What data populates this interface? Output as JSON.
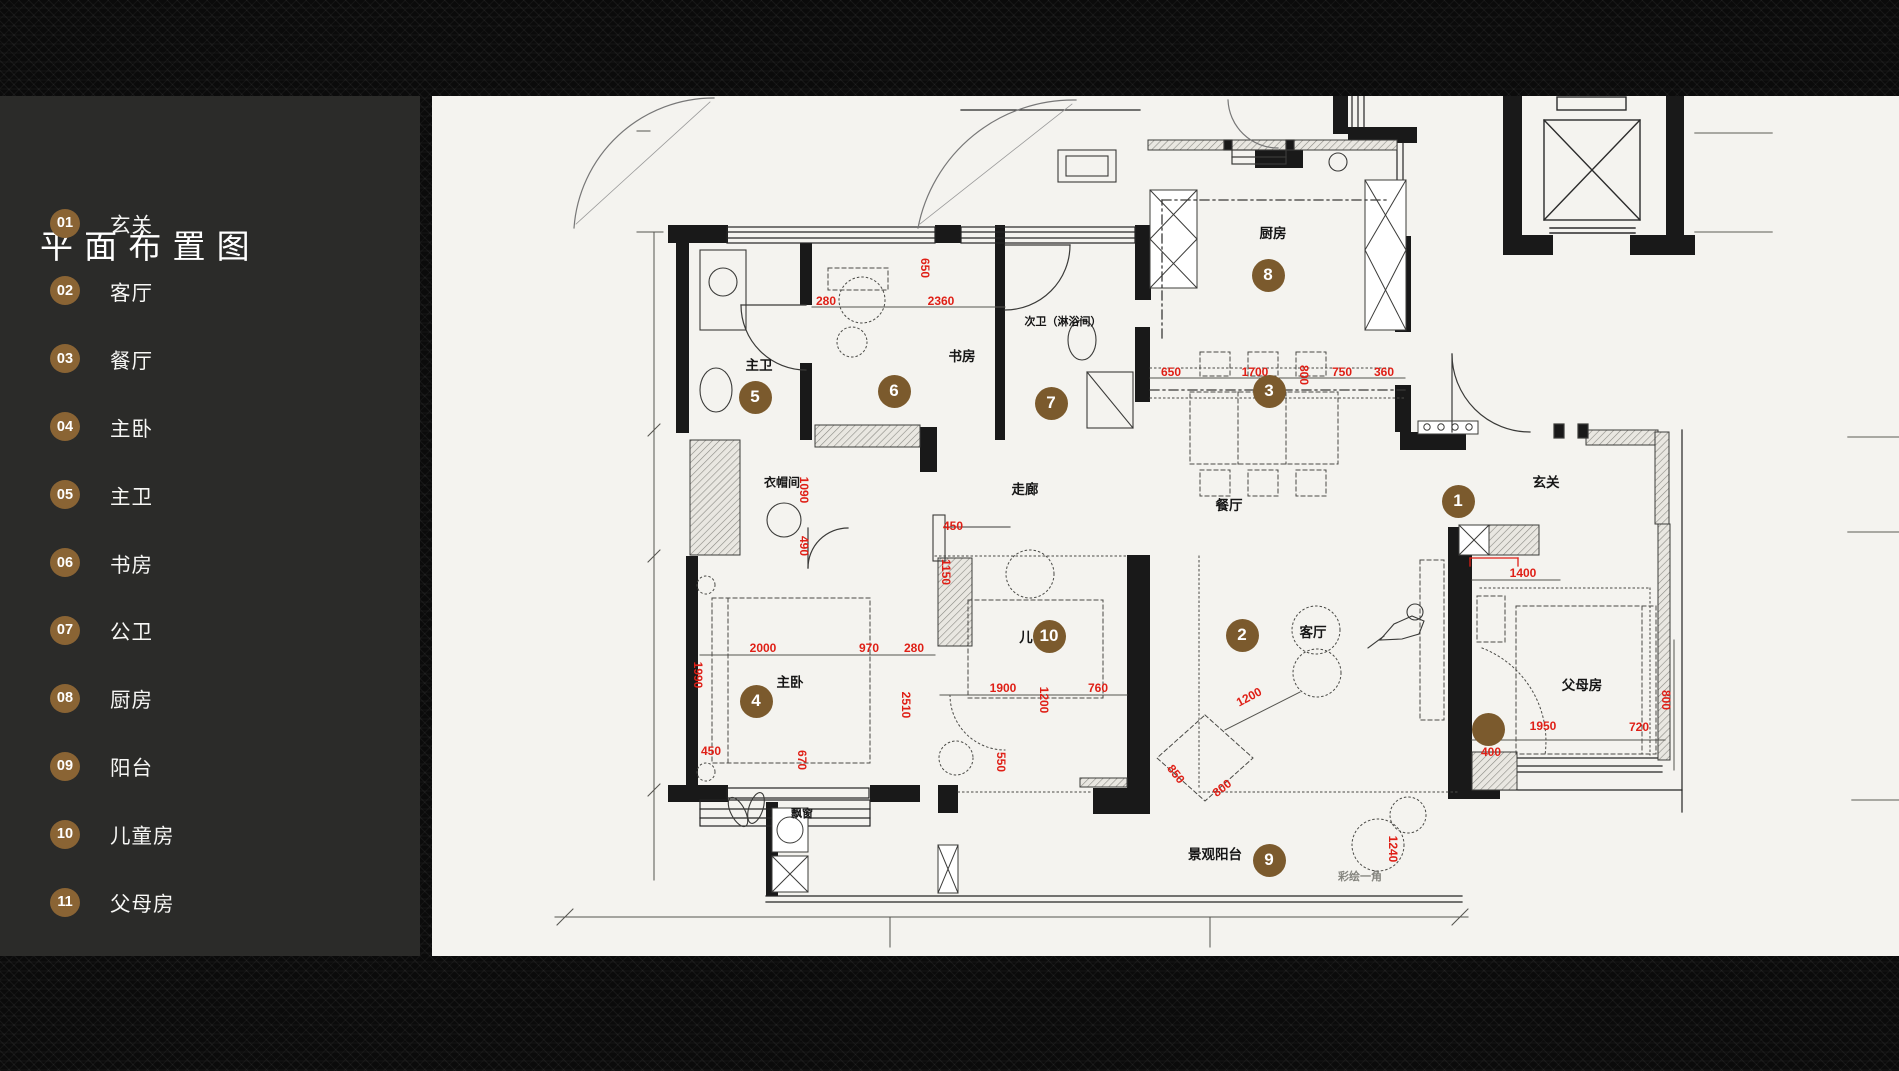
{
  "title": "平 面 布 置 图",
  "sidebar": {
    "items": [
      {
        "num": "01",
        "label": "玄关"
      },
      {
        "num": "02",
        "label": "客厅"
      },
      {
        "num": "03",
        "label": "餐厅"
      },
      {
        "num": "04",
        "label": "主卧"
      },
      {
        "num": "05",
        "label": "主卫"
      },
      {
        "num": "06",
        "label": "书房"
      },
      {
        "num": "07",
        "label": "公卫"
      },
      {
        "num": "08",
        "label": "厨房"
      },
      {
        "num": "09",
        "label": "阳台"
      },
      {
        "num": "10",
        "label": "儿童房"
      },
      {
        "num": "11",
        "label": "父母房"
      }
    ]
  },
  "colors": {
    "badge": "#8a6434",
    "marker": "#7b5a2d",
    "dim_red": "#df1f16",
    "sidebar_bg": "#2b2b29",
    "plan_bg": "#f4f3ef"
  },
  "plan": {
    "markers": [
      {
        "num": "1",
        "x": 1458,
        "y": 501
      },
      {
        "num": "2",
        "x": 1242,
        "y": 635
      },
      {
        "num": "3",
        "x": 1269,
        "y": 391
      },
      {
        "num": "4",
        "x": 756,
        "y": 701
      },
      {
        "num": "5",
        "x": 755,
        "y": 397
      },
      {
        "num": "6",
        "x": 894,
        "y": 391
      },
      {
        "num": "7",
        "x": 1051,
        "y": 403
      },
      {
        "num": "8",
        "x": 1268,
        "y": 275
      },
      {
        "num": "9",
        "x": 1269,
        "y": 860
      },
      {
        "num": "10",
        "x": 1049,
        "y": 636
      },
      {
        "num": "",
        "x": 1488,
        "y": 729
      }
    ],
    "room_labels": [
      {
        "t": "主卫",
        "x": 759,
        "y": 364
      },
      {
        "t": "书房",
        "x": 962,
        "y": 355
      },
      {
        "t": "次卫（淋浴间）",
        "x": 1063,
        "y": 321,
        "fs": 11
      },
      {
        "t": "厨房",
        "x": 1273,
        "y": 232
      },
      {
        "t": "玄关",
        "x": 1546,
        "y": 481
      },
      {
        "t": "餐厅",
        "x": 1229,
        "y": 504
      },
      {
        "t": "客厅",
        "x": 1313,
        "y": 631
      },
      {
        "t": "走廊",
        "x": 1025,
        "y": 488
      },
      {
        "t": "衣帽间",
        "x": 782,
        "y": 482,
        "fs": 12
      },
      {
        "t": "主卧",
        "x": 790,
        "y": 681
      },
      {
        "t": "儿",
        "x": 1026,
        "y": 636
      },
      {
        "t": "父母房",
        "x": 1582,
        "y": 684
      },
      {
        "t": "景观阳台",
        "x": 1215,
        "y": 853
      },
      {
        "t": "飘窗",
        "x": 802,
        "y": 813,
        "fs": 11
      },
      {
        "t": "彩绘一角",
        "x": 1360,
        "y": 876,
        "fs": 11,
        "c": "#85857f"
      }
    ],
    "dims": [
      {
        "t": "280",
        "x": 826,
        "y": 301
      },
      {
        "t": "2360",
        "x": 941,
        "y": 301
      },
      {
        "t": "650",
        "x": 925,
        "y": 268,
        "r": 90
      },
      {
        "t": "650",
        "x": 1171,
        "y": 372
      },
      {
        "t": "1700",
        "x": 1255,
        "y": 372
      },
      {
        "t": "800",
        "x": 1304,
        "y": 375,
        "r": 90
      },
      {
        "t": "750",
        "x": 1342,
        "y": 372
      },
      {
        "t": "360",
        "x": 1384,
        "y": 372
      },
      {
        "t": "1090",
        "x": 804,
        "y": 490,
        "r": 90
      },
      {
        "t": "490",
        "x": 804,
        "y": 546,
        "r": 90
      },
      {
        "t": "450",
        "x": 953,
        "y": 526
      },
      {
        "t": "1150",
        "x": 946,
        "y": 572,
        "r": 90
      },
      {
        "t": "2000",
        "x": 763,
        "y": 648
      },
      {
        "t": "970",
        "x": 869,
        "y": 648
      },
      {
        "t": "280",
        "x": 914,
        "y": 648
      },
      {
        "t": "1990",
        "x": 698,
        "y": 675,
        "r": 90
      },
      {
        "t": "2510",
        "x": 906,
        "y": 705,
        "r": 90
      },
      {
        "t": "450",
        "x": 711,
        "y": 751
      },
      {
        "t": "670",
        "x": 802,
        "y": 760,
        "r": 90
      },
      {
        "t": "1900",
        "x": 1003,
        "y": 688
      },
      {
        "t": "760",
        "x": 1098,
        "y": 688
      },
      {
        "t": "1200",
        "x": 1044,
        "y": 700,
        "r": 90
      },
      {
        "t": "550",
        "x": 1001,
        "y": 762,
        "r": 90
      },
      {
        "t": "1200",
        "x": 1249,
        "y": 697,
        "r": -28
      },
      {
        "t": "850",
        "x": 1176,
        "y": 774,
        "r": 52
      },
      {
        "t": "800",
        "x": 1222,
        "y": 788,
        "r": -38
      },
      {
        "t": "1400",
        "x": 1523,
        "y": 573
      },
      {
        "t": "1950",
        "x": 1543,
        "y": 726
      },
      {
        "t": "720",
        "x": 1639,
        "y": 727
      },
      {
        "t": "400",
        "x": 1491,
        "y": 752
      },
      {
        "t": "800",
        "x": 1666,
        "y": 700,
        "r": 90
      },
      {
        "t": "1240",
        "x": 1393,
        "y": 849,
        "r": 90
      }
    ]
  }
}
